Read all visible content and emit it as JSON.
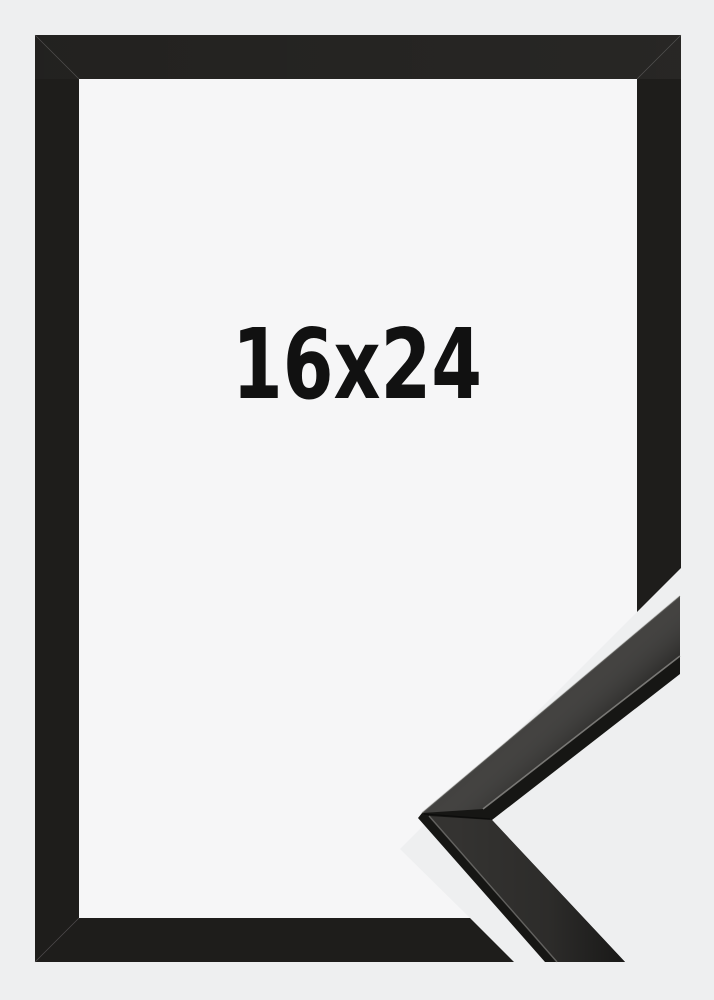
{
  "product": {
    "size_label": "16x24"
  },
  "colors": {
    "background": "#eeeff0",
    "frame_black": "#1e1d1b",
    "opening_white": "#f6f6f7",
    "label_text": "#111111",
    "moulding_edge_black": "#161614",
    "moulding_face_gray": "#343331",
    "moulding_highlight": "#8d8c89"
  }
}
